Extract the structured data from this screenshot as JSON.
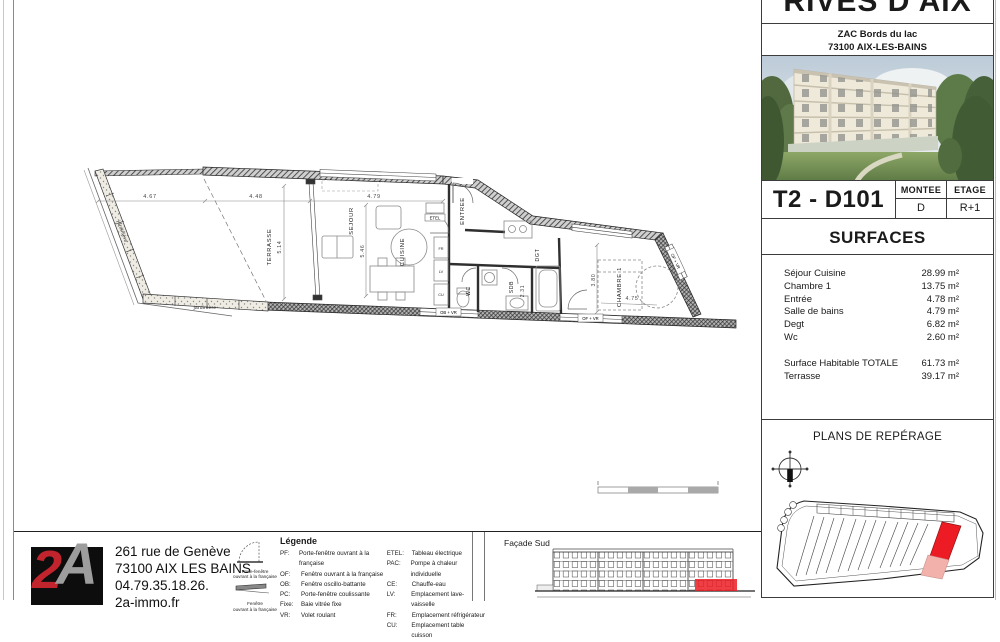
{
  "project": {
    "title": "RIVES D'AIX",
    "address_line1": "ZAC Bords du lac",
    "address_line2": "73100 AIX-LES-BAINS"
  },
  "unit": {
    "code": "T2 - D101",
    "montee_label": "MONTEE",
    "montee_value": "D",
    "etage_label": "ETAGE",
    "etage_value": "R+1"
  },
  "surfaces": {
    "title": "SURFACES",
    "rooms": [
      {
        "label": "Séjour Cuisine",
        "value": "28.99 m²"
      },
      {
        "label": "Chambre 1",
        "value": "13.75 m²"
      },
      {
        "label": "Entrée",
        "value": "4.78 m²"
      },
      {
        "label": "Salle de bains",
        "value": "4.79 m²"
      },
      {
        "label": "Degt",
        "value": "6.82 m²"
      },
      {
        "label": "Wc",
        "value": "2.60 m²"
      }
    ],
    "totals": [
      {
        "label": "Surface Habitable  TOTALE",
        "value": "61.73 m²"
      },
      {
        "label": "Terrasse",
        "value": "39.17 m²"
      }
    ]
  },
  "reperage": {
    "title": "PLANS DE REPÉRAGE"
  },
  "facade": {
    "title": "Façade Sud"
  },
  "agency": {
    "logo_char1": "2",
    "logo_char2": "A",
    "address_line1": "261 rue de Genève",
    "address_line2": "73100 AIX LES BAINS",
    "phone": "04.79.35.18.26.",
    "website": "2a-immo.fr"
  },
  "legend": {
    "title": "Légende",
    "icon1_line1": "Porte-fenêtre",
    "icon1_line2": "ouvrant à la française",
    "icon2_line1": "Fenêtre",
    "icon2_line2": "ouvrant à la française",
    "col1": [
      {
        "abbr": "PF:",
        "label": "Porte-fenêtre ouvrant à la française"
      },
      {
        "abbr": "OF:",
        "label": "Fenêtre ouvrant à la française"
      },
      {
        "abbr": "OB:",
        "label": "Fenêtre oscillo-battante"
      },
      {
        "abbr": "PC:",
        "label": "Porte-fenêtre coulissante"
      },
      {
        "abbr": "Fixe:",
        "label": "Baie vitrée fixe"
      },
      {
        "abbr": "VR:",
        "label": "Volet roulant"
      }
    ],
    "col2": [
      {
        "abbr": "ETEL:",
        "label": "Tableau électrique"
      },
      {
        "abbr": "PAC:",
        "label": "Pompe à chaleur individuelle"
      },
      {
        "abbr": "CE:",
        "label": "Chauffe-eau"
      },
      {
        "abbr": "LV:",
        "label": "Emplacement lave-vaisselle"
      },
      {
        "abbr": "FR:",
        "label": "Emplacement réfrigérateur"
      },
      {
        "abbr": "CU:",
        "label": "Emplacement table cuisson"
      }
    ]
  },
  "plan": {
    "labels": {
      "terrasse": "TERRASSE",
      "sejour": "SEJOUR",
      "cuisine": "CUISINE",
      "entree": "ENTREE",
      "wc": "WC",
      "sdb": "SDB",
      "dgt": "DGT",
      "chambre": "CHAMBRE 1",
      "jardiniere": "jardinière",
      "etel": "ETEL",
      "fr": "FR",
      "lv": "LV",
      "cu": "CU",
      "ob_vr": "OB + VR",
      "of_vr": "OF + VR"
    },
    "dims": {
      "terrace_w1": "4.67",
      "terrace_w2": "4.48",
      "sejour_w": "4.79",
      "terrace_d": "5.14",
      "sejour_d": "5.46",
      "chambre_d": "3.80",
      "chambre_w": "4.75",
      "sdb_w": "2.31"
    }
  },
  "colors": {
    "accent_red": "#ed1c24",
    "highlight_pink": "#f3b1ac",
    "wall": "#3a3a3a"
  }
}
